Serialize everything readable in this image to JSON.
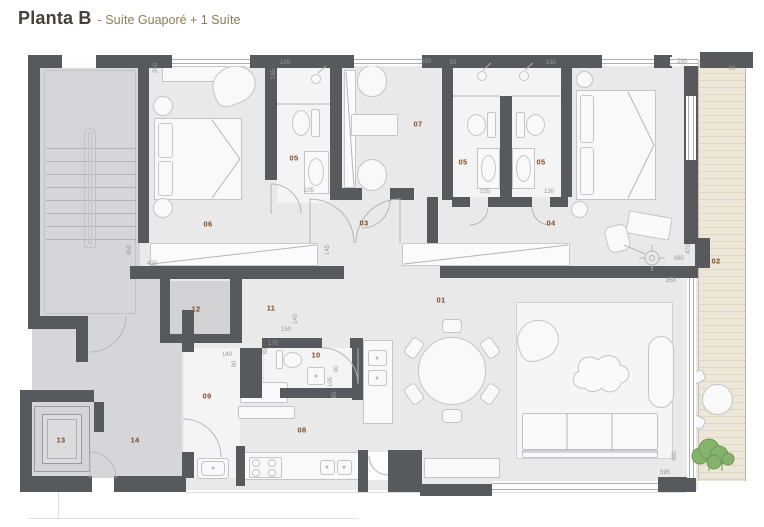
{
  "title": {
    "main": "Planta B",
    "subtitle": "- Suíte Guaporé + 1 Suíte"
  },
  "plan": {
    "rooms": [
      {
        "number": "01",
        "x": 441,
        "y": 300
      },
      {
        "number": "02",
        "x": 716,
        "y": 261
      },
      {
        "number": "03",
        "x": 364,
        "y": 223
      },
      {
        "number": "04",
        "x": 551,
        "y": 223
      },
      {
        "number": "05",
        "x": 294,
        "y": 158
      },
      {
        "number": "05",
        "x": 463,
        "y": 162
      },
      {
        "number": "05",
        "x": 541,
        "y": 162
      },
      {
        "number": "06",
        "x": 208,
        "y": 224
      },
      {
        "number": "07",
        "x": 418,
        "y": 124
      },
      {
        "number": "08",
        "x": 302,
        "y": 430
      },
      {
        "number": "09",
        "x": 207,
        "y": 396
      },
      {
        "number": "10",
        "x": 316,
        "y": 355
      },
      {
        "number": "11",
        "x": 271,
        "y": 308
      },
      {
        "number": "12",
        "x": 196,
        "y": 309
      },
      {
        "number": "13",
        "x": 61,
        "y": 440
      },
      {
        "number": "14",
        "x": 135,
        "y": 440
      }
    ],
    "dimensions": [
      {
        "text": "260",
        "x": 156,
        "y": 68,
        "rot": 90
      },
      {
        "text": "100",
        "x": 285,
        "y": 63,
        "rot": 0
      },
      {
        "text": "195",
        "x": 274,
        "y": 74,
        "rot": 90
      },
      {
        "text": "250",
        "x": 426,
        "y": 62,
        "rot": 0
      },
      {
        "text": "85",
        "x": 453,
        "y": 63,
        "rot": 0
      },
      {
        "text": "130",
        "x": 551,
        "y": 63,
        "rot": 0
      },
      {
        "text": "290",
        "x": 682,
        "y": 62,
        "rot": 0
      },
      {
        "text": "90",
        "x": 732,
        "y": 69,
        "rot": 0
      },
      {
        "text": "105",
        "x": 309,
        "y": 191,
        "rot": 0
      },
      {
        "text": "105",
        "x": 485,
        "y": 192,
        "rot": 0
      },
      {
        "text": "130",
        "x": 549,
        "y": 192,
        "rot": 0
      },
      {
        "text": "450",
        "x": 130,
        "y": 250,
        "rot": 90
      },
      {
        "text": "420",
        "x": 152,
        "y": 264,
        "rot": 0
      },
      {
        "text": "145",
        "x": 328,
        "y": 250,
        "rot": 90
      },
      {
        "text": "470",
        "x": 689,
        "y": 249,
        "rot": 90
      },
      {
        "text": "685",
        "x": 679,
        "y": 259,
        "rot": 0
      },
      {
        "text": "858",
        "x": 671,
        "y": 281,
        "rot": 0
      },
      {
        "text": "140",
        "x": 227,
        "y": 355,
        "rot": 0
      },
      {
        "text": "80",
        "x": 235,
        "y": 364,
        "rot": 90
      },
      {
        "text": "150",
        "x": 286,
        "y": 330,
        "rot": 0
      },
      {
        "text": "140",
        "x": 296,
        "y": 319,
        "rot": 90
      },
      {
        "text": "170",
        "x": 273,
        "y": 344,
        "rot": 0
      },
      {
        "text": "85",
        "x": 266,
        "y": 351,
        "rot": 90
      },
      {
        "text": "90",
        "x": 337,
        "y": 369,
        "rot": 90
      },
      {
        "text": "105",
        "x": 331,
        "y": 382,
        "rot": 90
      },
      {
        "text": "85",
        "x": 335,
        "y": 395,
        "rot": 90
      },
      {
        "text": "480",
        "x": 675,
        "y": 456,
        "rot": 90
      },
      {
        "text": "595",
        "x": 665,
        "y": 473,
        "rot": 0
      }
    ]
  },
  "colors": {
    "wall": "#58595d",
    "floor": "#e9e9ea",
    "common_floor": "#d6d6d8",
    "deck": "#ece7d9",
    "room_label": "#7c4b28",
    "dimension_label": "#9a9a9e",
    "title": "#474139",
    "subtitle": "#8d7d54",
    "plant_green": "#85b36d"
  }
}
